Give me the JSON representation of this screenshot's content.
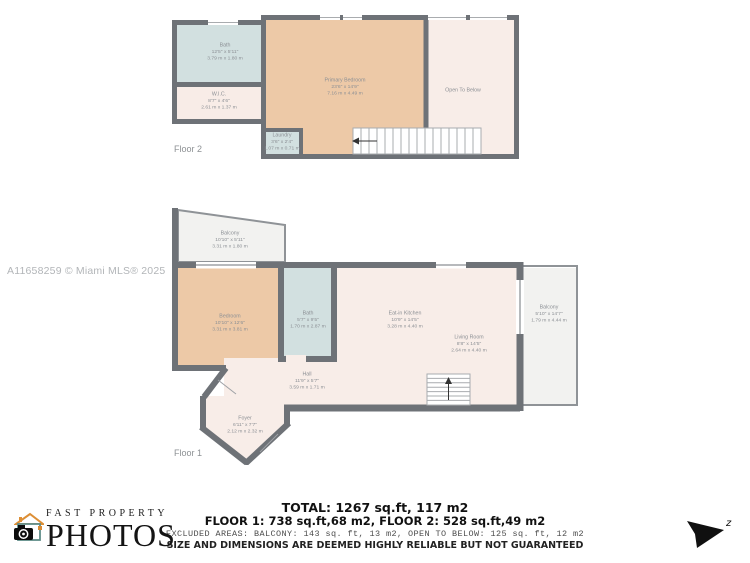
{
  "watermark": "A11658259 © Miami MLS® 2025",
  "floor2": {
    "caption": "Floor 2",
    "rooms": {
      "bath": {
        "name": "Bath",
        "dim_ft": "12'5\" x 5'11\"",
        "dim_m": "3.79 m x 1.80 m"
      },
      "wic": {
        "name": "W.I.C.",
        "dim_ft": "8'7\" x 4'6\"",
        "dim_m": "2.61 m x 1.37 m"
      },
      "primary_bedroom": {
        "name": "Primary Bedroom",
        "dim_ft": "23'6\" x 14'9\"",
        "dim_m": "7.16 m x 4.49 m"
      },
      "laundry": {
        "name": "Laundry",
        "dim_ft": "3'6\" x 2'4\"",
        "dim_m": "1.07 m x 0.71 m"
      },
      "open_to_below": {
        "name": "Open To Below"
      }
    }
  },
  "floor1": {
    "caption": "Floor 1",
    "rooms": {
      "balcony_upper_left": {
        "name": "Balcony",
        "dim_ft": "10'10\" x 5'11\"",
        "dim_m": "3.31 m x 1.80 m"
      },
      "bedroom": {
        "name": "Bedroom",
        "dim_ft": "10'10\" x 12'6\"",
        "dim_m": "3.31 m x 3.81 m"
      },
      "bath": {
        "name": "Bath",
        "dim_ft": "5'7\" x 9'5\"",
        "dim_m": "1.70 m x 2.87 m"
      },
      "eat_in_kitchen": {
        "name": "Eat-in Kitchen",
        "dim_ft": "10'9\" x 14'5\"",
        "dim_m": "3.28 m x 4.40 m"
      },
      "living_room": {
        "name": "Living Room",
        "dim_ft": "8'8\" x 14'5\"",
        "dim_m": "2.64 m x 4.40 m"
      },
      "balcony_right": {
        "name": "Balcony",
        "dim_ft": "5'10\" x 14'7\"",
        "dim_m": "1.79 m x 4.44 m"
      },
      "hall": {
        "name": "Hall",
        "dim_ft": "11'9\" x 5'7\"",
        "dim_m": "3.59 m x 1.71 m"
      },
      "foyer": {
        "name": "Foyer",
        "dim_ft": "6'11\" x 7'7\"",
        "dim_m": "2.12 m x 2.32 m"
      }
    }
  },
  "summary": {
    "total": "TOTAL: 1267 sq.ft, 117 m2",
    "floors": "FLOOR 1: 738 sq.ft,68 m2, FLOOR 2: 528 sq.ft,49 m2",
    "excluded": "EXCLUDED AREAS: BALCONY: 143 sq. ft, 13 m2, OPEN TO BELOW: 125 sq. ft, 12 m2",
    "disclaimer": "SIZE AND DIMENSIONS ARE DEEMED HIGHLY RELIABLE BUT NOT GUARANTEED"
  },
  "logo": {
    "line1": "FAST PROPERTY",
    "line2": "PHOTOS"
  },
  "compass": {
    "label": "z"
  },
  "colors": {
    "wall": "#6e7277",
    "bedroom_fill": "#edc9a7",
    "bath_fill": "#d2e0e0",
    "room_fill": "#f8ede8",
    "balcony_fill": "#f2f2f0",
    "label_gray": "#8b8f94",
    "logo_teal": "#5f8d89",
    "logo_orange": "#dd8f36"
  }
}
